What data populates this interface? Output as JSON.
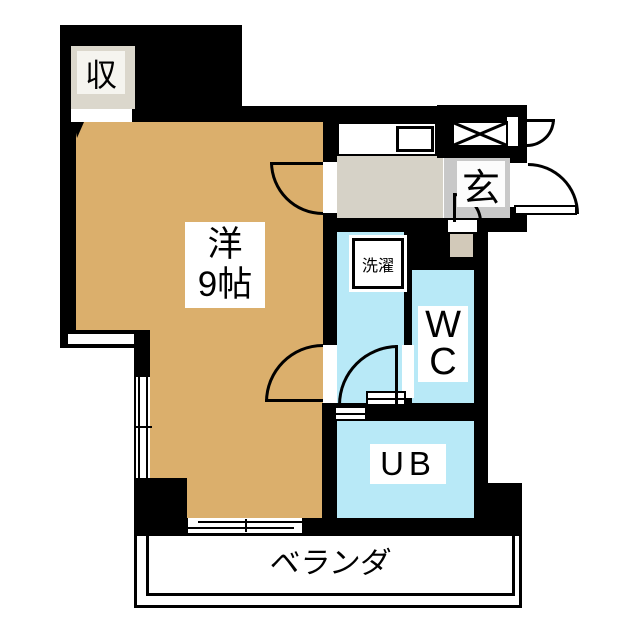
{
  "floorplan": {
    "rooms": {
      "living": {
        "label_line1": "洋",
        "label_line2": "9帖"
      },
      "closet": {
        "label": "収"
      },
      "entrance": {
        "label": "玄"
      },
      "laundry": {
        "label": "洗濯"
      },
      "toilet": {
        "label_line1": "W",
        "label_line2": "C"
      },
      "bath": {
        "label": "UB"
      },
      "balcony": {
        "label": "ベランダ"
      }
    },
    "colors": {
      "wall": "#000000",
      "living": "#DBAF6C",
      "water": "#B8E9F7",
      "kitchen": "#D6D2C7",
      "entrance": "#C8C8C8",
      "step": "#D2C9B9",
      "closet": "#DBD7CC",
      "bg": "#FFFFFF",
      "line": "#000000"
    }
  }
}
